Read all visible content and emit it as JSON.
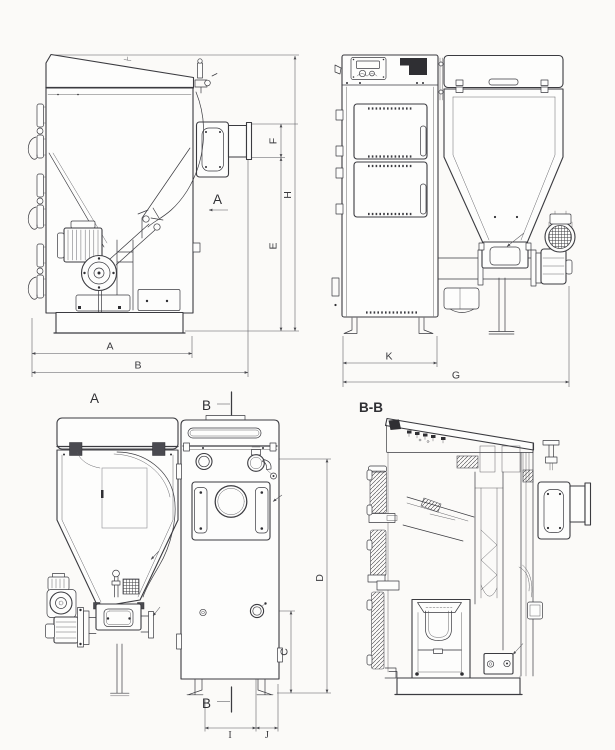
{
  "colors": {
    "background": "#fbfaf8",
    "ink": "#3b3b40",
    "dim_lines": "#55555a"
  },
  "views": {
    "side": {
      "section_arrow_label": "A",
      "dim_width_a": "A",
      "dim_width_b": "B",
      "dim_f": "F",
      "dim_e": "E",
      "dim_h": "H"
    },
    "front": {
      "dim_k": "K",
      "dim_g": "G"
    },
    "hopper_rear": {
      "title": "A"
    },
    "rear": {
      "section_label_top": "B",
      "section_label_bottom": "B",
      "dim_c": "C",
      "dim_d": "D",
      "dim_i": "I",
      "dim_j": "J"
    },
    "section_bb": {
      "title": "B-B"
    }
  }
}
